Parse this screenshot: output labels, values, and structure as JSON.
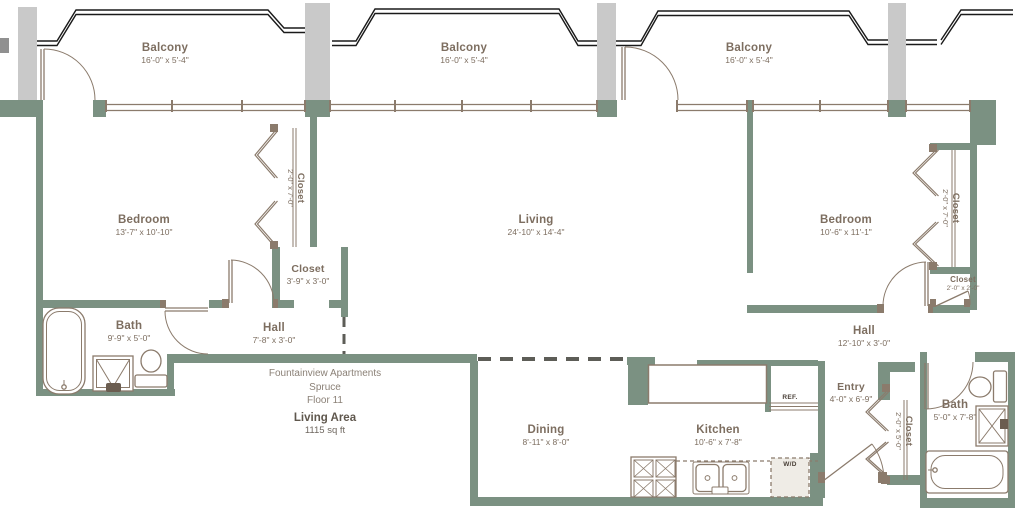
{
  "info": {
    "title": "Fountainview Apartments",
    "unit": "Spruce",
    "floor": "Floor 11",
    "area_label": "Living Area",
    "area_value": "1115 sq ft"
  },
  "rooms": [
    {
      "id": "balcony-1",
      "name": "Balcony",
      "dims": "16'-0\" x 5'-4\""
    },
    {
      "id": "balcony-2",
      "name": "Balcony",
      "dims": "16'-0\" x 5'-4\""
    },
    {
      "id": "balcony-3",
      "name": "Balcony",
      "dims": "16'-0\" x 5'-4\""
    },
    {
      "id": "bedroom-1",
      "name": "Bedroom",
      "dims": "13'-7\" x 10'-10\""
    },
    {
      "id": "living",
      "name": "Living",
      "dims": "24'-10\" x 14'-4\""
    },
    {
      "id": "bedroom-2",
      "name": "Bedroom",
      "dims": "10'-6\" x 11'-1\""
    },
    {
      "id": "closet-bedroom-1",
      "name": "Closet",
      "dims": "2'-0\" x 7'-0\""
    },
    {
      "id": "closet-hall-1",
      "name": "Closet",
      "dims": "3'-9\" x 3'-0\""
    },
    {
      "id": "bath-1",
      "name": "Bath",
      "dims": "9'-9\" x 5'-0\""
    },
    {
      "id": "hall-1",
      "name": "Hall",
      "dims": "7'-8\" x 3'-0\""
    },
    {
      "id": "closet-bedroom-2",
      "name": "Closet",
      "dims": "2'-0\" x 7'-0\""
    },
    {
      "id": "closet-bedroom-2-small",
      "name": "Closet",
      "dims": "2'-0\" x 2'-0\""
    },
    {
      "id": "hall-2",
      "name": "Hall",
      "dims": "12'-10\" x 3'-0\""
    },
    {
      "id": "entry",
      "name": "Entry",
      "dims": "4'-0\" x 6'-9\""
    },
    {
      "id": "closet-entry",
      "name": "Closet",
      "dims": "2'-0\" x 5'-0\""
    },
    {
      "id": "bath-2",
      "name": "Bath",
      "dims": "5'-0\" x 7'-8\""
    },
    {
      "id": "dining",
      "name": "Dining",
      "dims": "8'-11\" x 8'-0\""
    },
    {
      "id": "kitchen",
      "name": "Kitchen",
      "dims": "10'-6\" x 7'-8\""
    }
  ],
  "appliances": {
    "refrigerator": "REF.",
    "washer_dryer": "W/D"
  },
  "colors": {
    "wall": "#7b9182",
    "column": "#c9c9c9",
    "line": "#8b7b6c",
    "balcony_outline": "#1a1a1a",
    "room_label": "#7d6e60",
    "info_text": "#8b8177",
    "info_dark": "#5f574d",
    "dash": "#5d5d57"
  }
}
